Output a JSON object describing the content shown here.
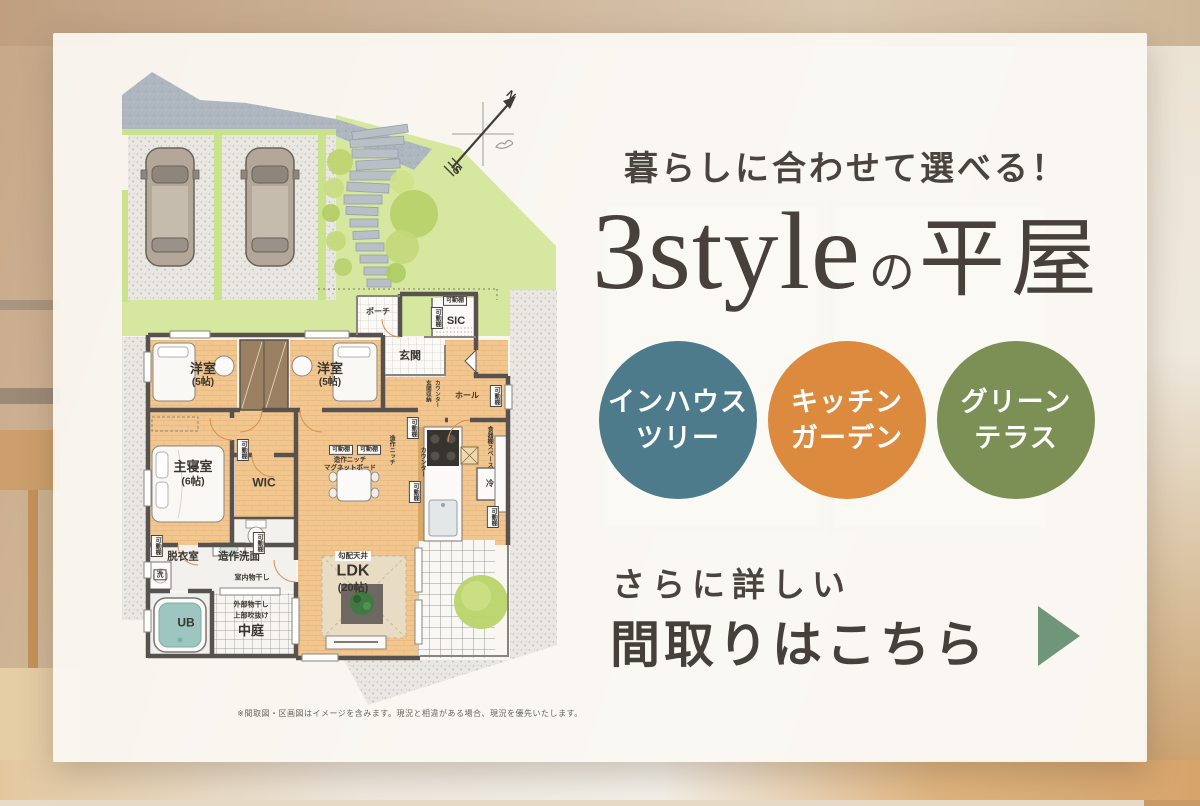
{
  "headline": "暮らしに合わせて選べる！",
  "title": {
    "latin": "3style",
    "particle": "の",
    "jp": "平屋"
  },
  "style_circles": [
    {
      "lines": [
        "インハウス",
        "ツリー"
      ],
      "color": "#4e7b8b"
    },
    {
      "lines": [
        "キッチン",
        "ガーデン"
      ],
      "color": "#dc8a3d"
    },
    {
      "lines": [
        "グリーン",
        "テラス"
      ],
      "color": "#7c9055"
    }
  ],
  "cta": {
    "lead": "さらに詳しい",
    "main": "間取りはこちら",
    "arrow_color": "#6f9679"
  },
  "disclaimer": "※間取図・区画図はイメージを含みます。現況と相違がある場合、現況を優先いたします。",
  "floorplan": {
    "labels": [
      {
        "t": "ポーチ",
        "x": 378,
        "y": 312,
        "s": 8
      },
      {
        "t": "可動棚",
        "x": 455,
        "y": 301,
        "s": 6,
        "b": 1
      },
      {
        "t": "可動棚",
        "x": 437,
        "y": 318,
        "s": 6,
        "b": 1,
        "v": 1
      },
      {
        "t": "SIC",
        "x": 456,
        "y": 322,
        "s": 11
      },
      {
        "t": "玄関",
        "x": 410,
        "y": 357,
        "s": 11
      },
      {
        "t": "玄関収納",
        "x": 427,
        "y": 391,
        "s": 5.5,
        "v": 1
      },
      {
        "t": "カウンター",
        "x": 436,
        "y": 394,
        "s": 5.5,
        "v": 1
      },
      {
        "t": "ホール",
        "x": 467,
        "y": 396,
        "s": 8
      },
      {
        "t": "可動棚",
        "x": 496,
        "y": 396,
        "s": 6,
        "b": 1,
        "v": 1
      },
      {
        "t": "洋室",
        "x": 203,
        "y": 369,
        "s": 13
      },
      {
        "t": "(5帖)",
        "x": 203,
        "y": 383,
        "s": 10
      },
      {
        "t": "洋室",
        "x": 330,
        "y": 369,
        "s": 13
      },
      {
        "t": "(5帖)",
        "x": 330,
        "y": 383,
        "s": 10
      },
      {
        "t": "主寝室",
        "x": 193,
        "y": 467,
        "s": 13
      },
      {
        "t": "(6帖)",
        "x": 193,
        "y": 482,
        "s": 10.5
      },
      {
        "t": "可動棚",
        "x": 243,
        "y": 450,
        "s": 6,
        "b": 1,
        "v": 1
      },
      {
        "t": "WIC",
        "x": 264,
        "y": 483,
        "s": 12
      },
      {
        "t": "可動棚",
        "x": 341,
        "y": 450,
        "s": 6,
        "b": 1
      },
      {
        "t": "可動棚",
        "x": 369,
        "y": 450,
        "s": 6,
        "b": 1
      },
      {
        "t": "造作ニッチ",
        "x": 350,
        "y": 461,
        "s": 6.5
      },
      {
        "t": "マグネットボード",
        "x": 350,
        "y": 469,
        "s": 6.5
      },
      {
        "t": "造作ニッチ",
        "x": 391,
        "y": 450,
        "s": 6,
        "v": 1
      },
      {
        "t": "可動棚",
        "x": 413,
        "y": 428,
        "s": 6,
        "b": 1,
        "v": 1
      },
      {
        "t": "カウンター",
        "x": 422,
        "y": 462,
        "s": 6,
        "v": 1
      },
      {
        "t": "可動棚",
        "x": 415,
        "y": 492,
        "s": 6,
        "b": 1,
        "v": 1
      },
      {
        "t": "食器棚スペース",
        "x": 489,
        "y": 447,
        "s": 6,
        "v": 1
      },
      {
        "t": "冷",
        "x": 490,
        "y": 484,
        "s": 8
      },
      {
        "t": "可動棚",
        "x": 493,
        "y": 517,
        "s": 6,
        "b": 1,
        "v": 1
      },
      {
        "t": "勾配天井",
        "x": 353,
        "y": 556,
        "s": 7.5,
        "b": 2
      },
      {
        "t": "LDK",
        "x": 353,
        "y": 572,
        "s": 16
      },
      {
        "t": "(20帖)",
        "x": 353,
        "y": 589,
        "s": 11
      },
      {
        "t": "可動棚",
        "x": 157,
        "y": 546,
        "s": 6,
        "b": 1,
        "v": 1
      },
      {
        "t": "脱衣室",
        "x": 183,
        "y": 557,
        "s": 10.5
      },
      {
        "t": "造作洗面",
        "x": 239,
        "y": 557,
        "s": 10.5
      },
      {
        "t": "可動棚",
        "x": 259,
        "y": 543,
        "s": 6,
        "b": 1,
        "v": 1
      },
      {
        "t": "洗",
        "x": 160,
        "y": 575,
        "s": 7,
        "b": 1
      },
      {
        "t": "室内物干し",
        "x": 252,
        "y": 578,
        "s": 7
      },
      {
        "t": "UB",
        "x": 186,
        "y": 623,
        "s": 12
      },
      {
        "t": "外部物干し",
        "x": 251,
        "y": 605,
        "s": 7
      },
      {
        "t": "上部吹抜け",
        "x": 251,
        "y": 616,
        "s": 7
      },
      {
        "t": "中庭",
        "x": 251,
        "y": 631,
        "s": 13
      },
      {
        "t": "N",
        "x": 510,
        "y": 96,
        "s": 11,
        "r": 45
      },
      {
        "t": "S",
        "x": 456,
        "y": 171,
        "s": 11,
        "r": 45
      }
    ]
  }
}
